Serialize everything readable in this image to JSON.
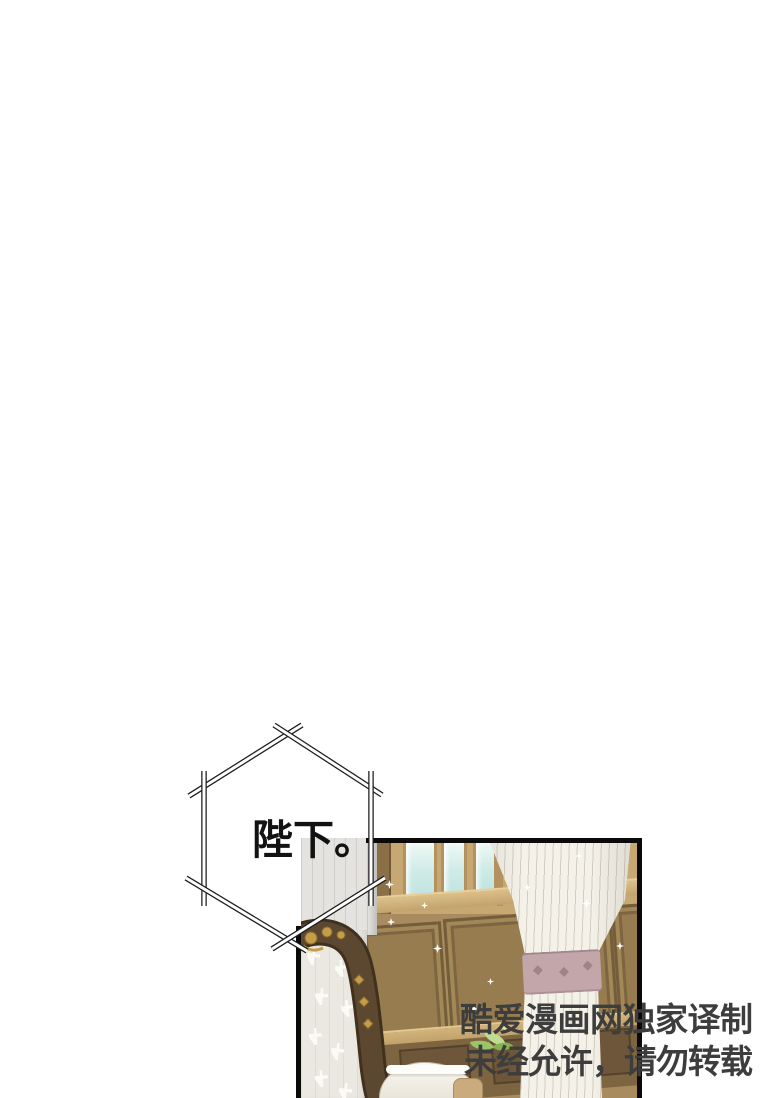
{
  "page": {
    "type": "comic-page",
    "background_color": "#ffffff"
  },
  "speech_bubble": {
    "shape": "hexagon-sticks",
    "text": "陛下。",
    "fill_color": "#ffffff",
    "outline_color": "#1c1c1c",
    "text_color": "#121212"
  },
  "panel": {
    "border_color": "#0a0a0a",
    "colors": {
      "wood_wall": "#a88c5f",
      "wood_light_rail": "#d2b37b",
      "wood_dark_panel": "#735d3a",
      "window_glass": "#cdeae6",
      "curtain_white": "#f4f1e9",
      "curtain_tie": "#c2a6aa",
      "lace_curtain": "#eae8e1",
      "chair_wood": "#5a4631",
      "chair_gold": "#c49d49",
      "leaf_green": "#9cc468"
    }
  },
  "watermark": {
    "line1": "酷爱漫画网独家译制",
    "line2": "未经允许，请勿转载",
    "color": "#3d3d3d"
  }
}
